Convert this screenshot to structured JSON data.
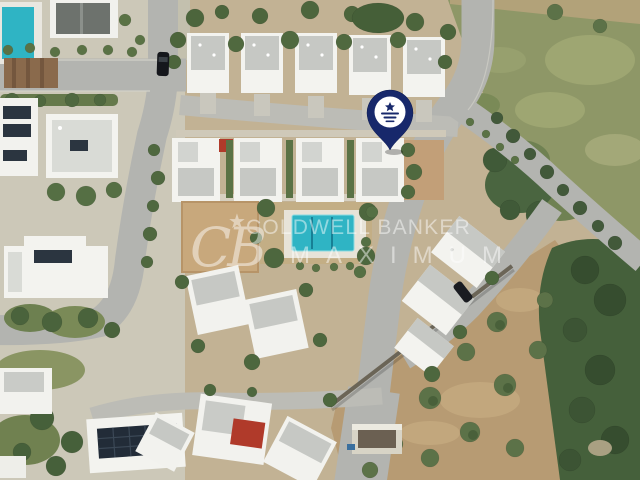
{
  "scene": {
    "description": "Aerial drone photograph of a Mediterranean white-villa development with a communal swimming pool, curving asphalt roads, a green scrubland field and an olive-tree dirt field",
    "marker": "navy location pin with white brand roundel over one villa"
  },
  "watermark": {
    "monogram": "CB",
    "star": "★",
    "line1": "COLDWELL BANKER",
    "line2": "MAXIMUM",
    "opacity": 0.48
  },
  "palette": {
    "pin_navy": "#17286b",
    "pool_turquoise": "#2fb4c4",
    "road_gray": "#b3b4b0",
    "villa_white": "#f3f3ef",
    "roof_gray": "#c6c8c4",
    "field_green": "#8e9767",
    "dirt_tan": "#b79b73",
    "shrub_dark": "#45603b",
    "solar_panel": "#222c38",
    "red_awning": "#b03a2a"
  }
}
